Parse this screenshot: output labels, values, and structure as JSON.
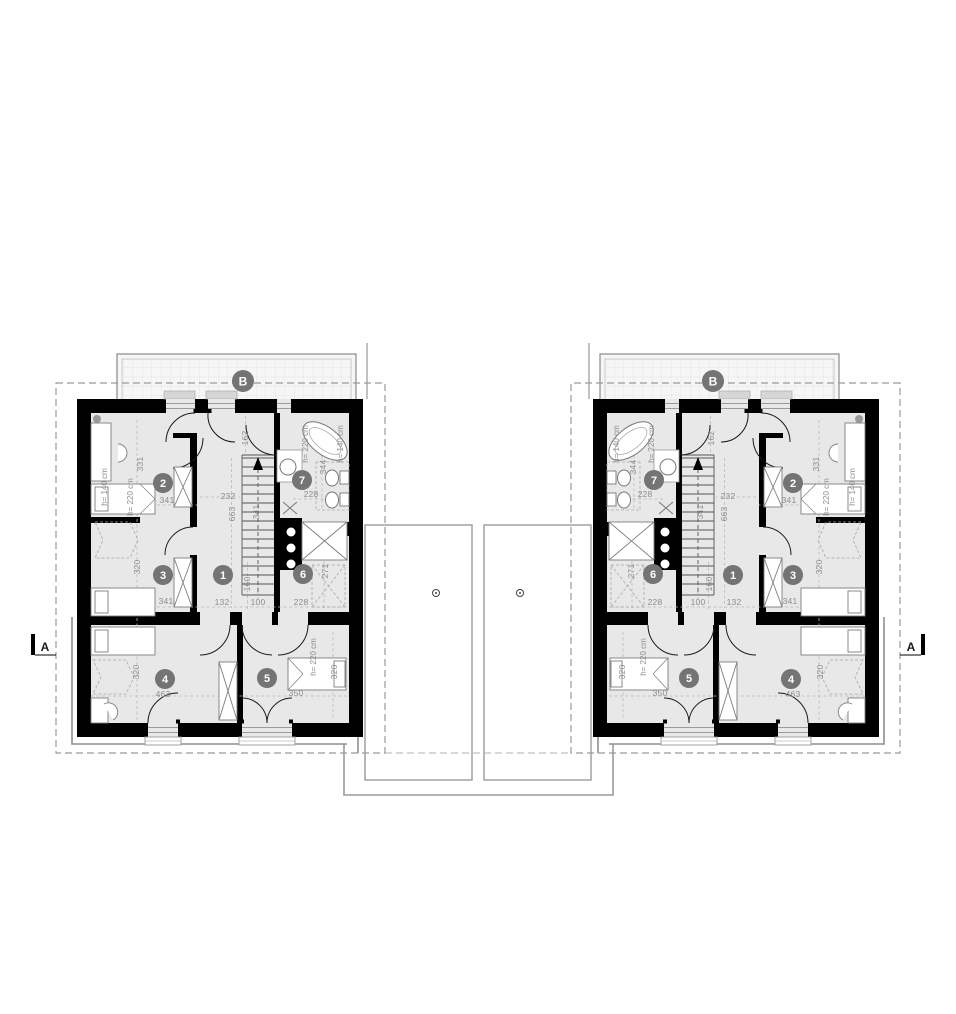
{
  "plan": {
    "rooms": [
      {
        "number": "1",
        "dims": [
          "132",
          "100",
          "160"
        ]
      },
      {
        "number": "2",
        "dims": [
          "341",
          "331"
        ],
        "heights": [
          "h= 220 cm",
          "h= 140 cm"
        ]
      },
      {
        "number": "3",
        "dims": [
          "341",
          "320"
        ]
      },
      {
        "number": "4",
        "dims": [
          "463",
          "320"
        ]
      },
      {
        "number": "5",
        "dims": [
          "350",
          "320"
        ],
        "heights": [
          "h= 220 cm"
        ]
      },
      {
        "number": "6",
        "dims": [
          "228",
          "271"
        ]
      },
      {
        "number": "7",
        "dims": [
          "228",
          "344"
        ],
        "heights": [
          "h= 220 cm",
          "h= 140 cm"
        ]
      }
    ],
    "stairwell_dims": [
      "232",
      "663",
      "341",
      "162"
    ],
    "markers": {
      "section_a": "A",
      "section_b": "B"
    }
  }
}
